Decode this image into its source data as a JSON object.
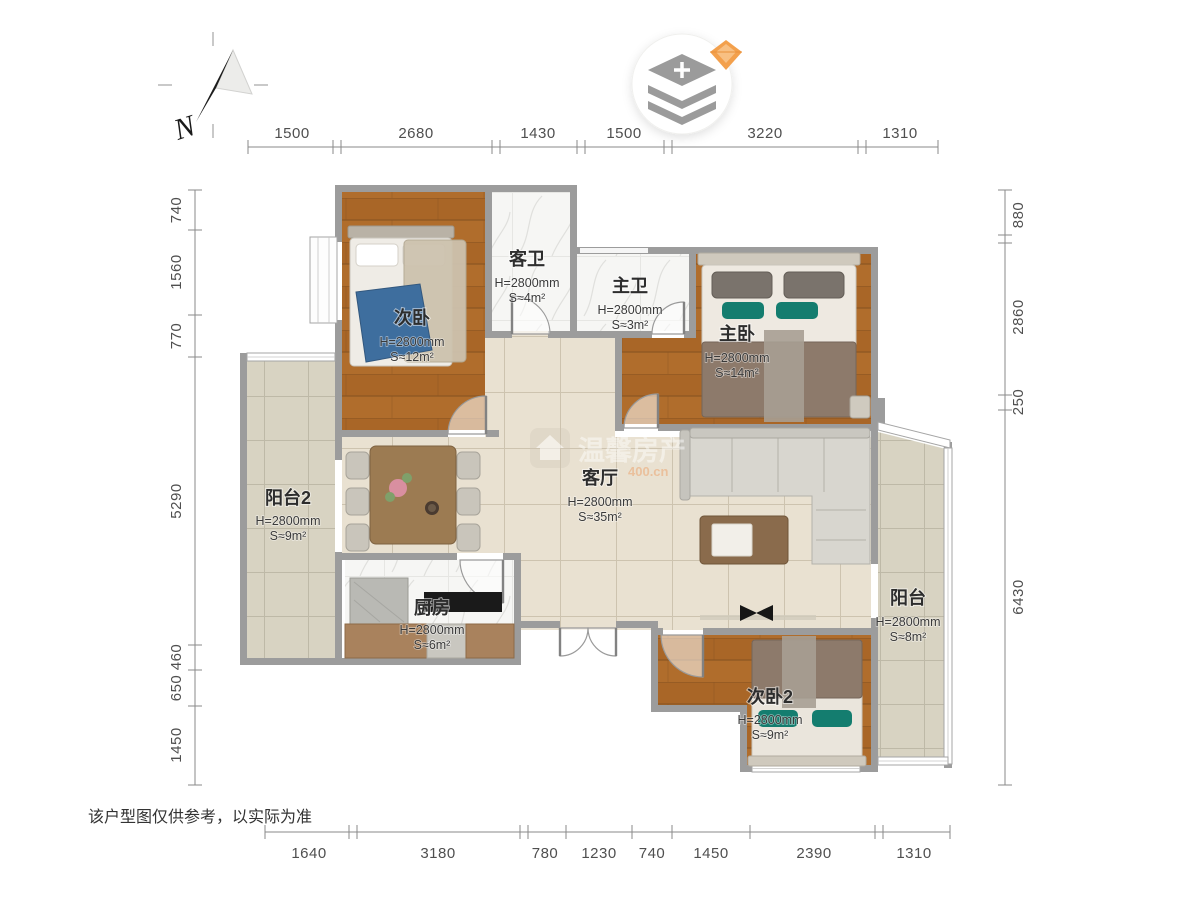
{
  "meta": {
    "disclaimer": "该户型图仅供参考，以实际为准"
  },
  "compass": {
    "label": "N"
  },
  "watermark": {
    "name": "温馨房产",
    "domain": "400.cn"
  },
  "rooms": {
    "ciwo": {
      "name": "次卧",
      "height": "H=2800mm",
      "area": "S≈12m²"
    },
    "kewei": {
      "name": "客卫",
      "height": "H=2800mm",
      "area": "S≈4m²"
    },
    "zhuwei": {
      "name": "主卫",
      "height": "H=2800mm",
      "area": "S≈3m²"
    },
    "zhuwo": {
      "name": "主卧",
      "height": "H=2800mm",
      "area": "S≈14m²"
    },
    "keting": {
      "name": "客厅",
      "height": "H=2800mm",
      "area": "S≈35m²"
    },
    "yangtai2": {
      "name": "阳台2",
      "height": "H=2800mm",
      "area": "S≈9m²"
    },
    "chufang": {
      "name": "厨房",
      "height": "H=2800mm",
      "area": "S≈6m²"
    },
    "yangtai": {
      "name": "阳台",
      "height": "H=2800mm",
      "area": "S≈8m²"
    },
    "ciwo2": {
      "name": "次卧2",
      "height": "H=2800mm",
      "area": "S≈9m²"
    }
  },
  "dimensions": {
    "top": [
      "1500",
      "2680",
      "1430",
      "1500",
      "3220",
      "1310"
    ],
    "bottom": [
      "1640",
      "3180",
      "780",
      "1230",
      "740",
      "1450",
      "2390",
      "1310"
    ],
    "left": [
      "740",
      "1560",
      "770",
      "5290",
      "460",
      "650",
      "1450"
    ],
    "right": [
      "880",
      "2860",
      "250",
      "6430"
    ]
  },
  "colors": {
    "wood": "#b06d2c",
    "living_tile": "#e9e1d1",
    "balcony_tile": "#d8d3c2",
    "wall": "#9c9c9c",
    "teal_pillow": "#147d6f",
    "gem": "#f3a04c"
  }
}
